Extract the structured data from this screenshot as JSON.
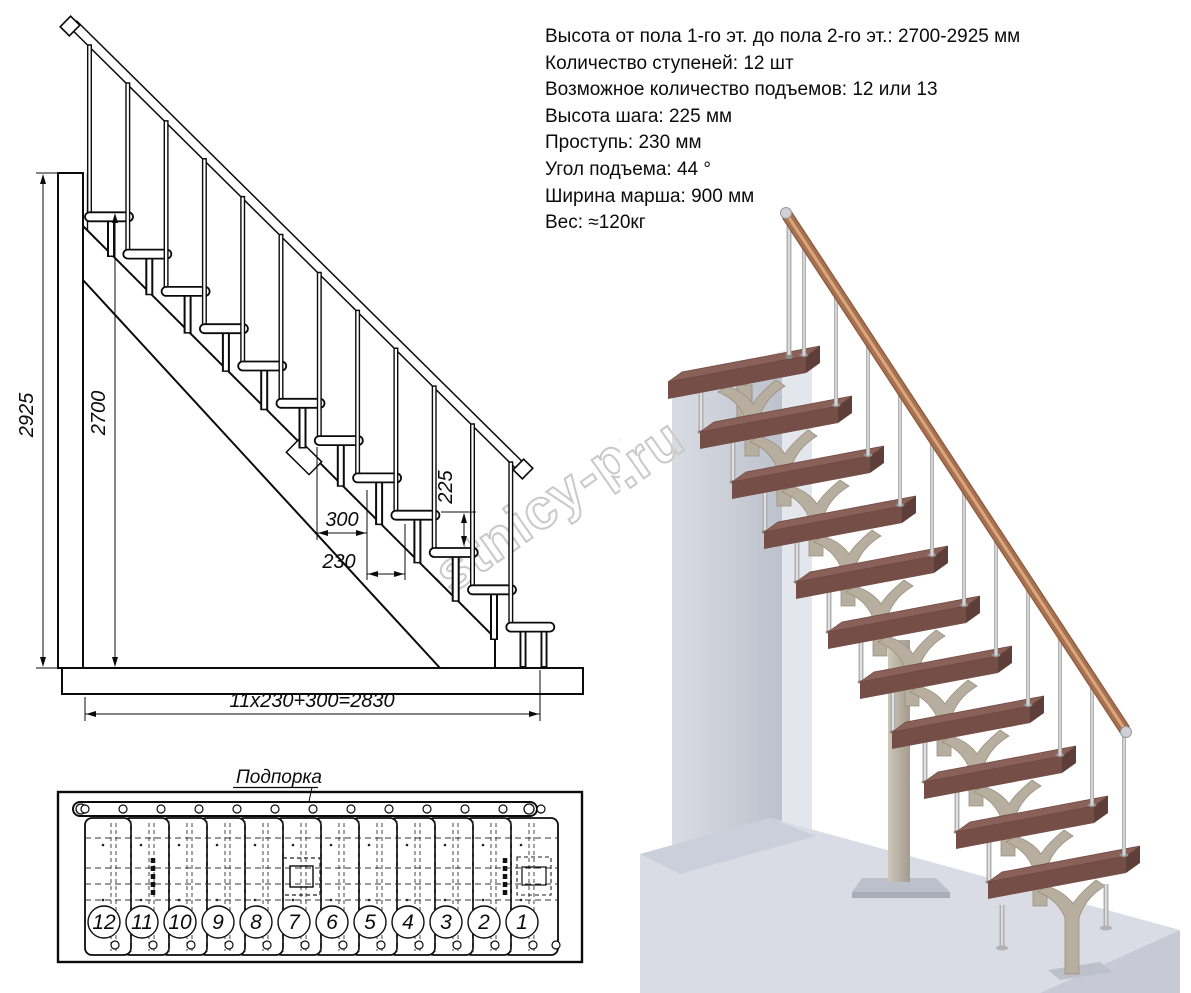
{
  "specs": {
    "lines": [
      "Высота от пола 1-го эт. до пола 2-го эт.: 2700-2925 мм",
      "Количество ступеней: 12 шт",
      "Возможное количество подъемов: 12 или 13",
      "Высота шага: 225 мм",
      "Проступь: 230 мм",
      "Угол подъема: 44 °",
      "Ширина марша: 900 мм",
      "Вес: ≈120кг"
    ]
  },
  "elevation": {
    "step_count": 12,
    "dims": {
      "total_height": "2925",
      "flight_height": "2700",
      "riser": "225",
      "top_tread": "300",
      "going": "230",
      "run_formula": "11x230+300=2830"
    }
  },
  "plan": {
    "support_label": "Подпорка",
    "step_numbers": [
      "12",
      "11",
      "10",
      "9",
      "8",
      "7",
      "6",
      "5",
      "4",
      "3",
      "2",
      "1"
    ]
  },
  "render3d": {
    "tread_count": 11,
    "colors": {
      "tread_top": "#8a6159",
      "tread_front": "#744e47",
      "tread_side": "#5e3e38",
      "metal": "#b0b0b2",
      "metal_hl": "#e0e0e0",
      "bracket": "#b7aea0",
      "bracket_edge": "#98907f",
      "handrail": "#a9714f",
      "handrail_hl": "#d8a77e",
      "wall_a": "#d9dce3",
      "wall_b": "#bcc1cc",
      "wall_side": "#e3e6ed",
      "wall_top": "#eef0f4",
      "floor": "#d9dce5",
      "floor_dark": "#cbcfda",
      "floor_front": "#c7cad5",
      "plate": "#bcc0ca"
    }
  },
  "watermark": {
    "text": "lestnicy-prosto.ru",
    "color": "#c9c9c9"
  }
}
